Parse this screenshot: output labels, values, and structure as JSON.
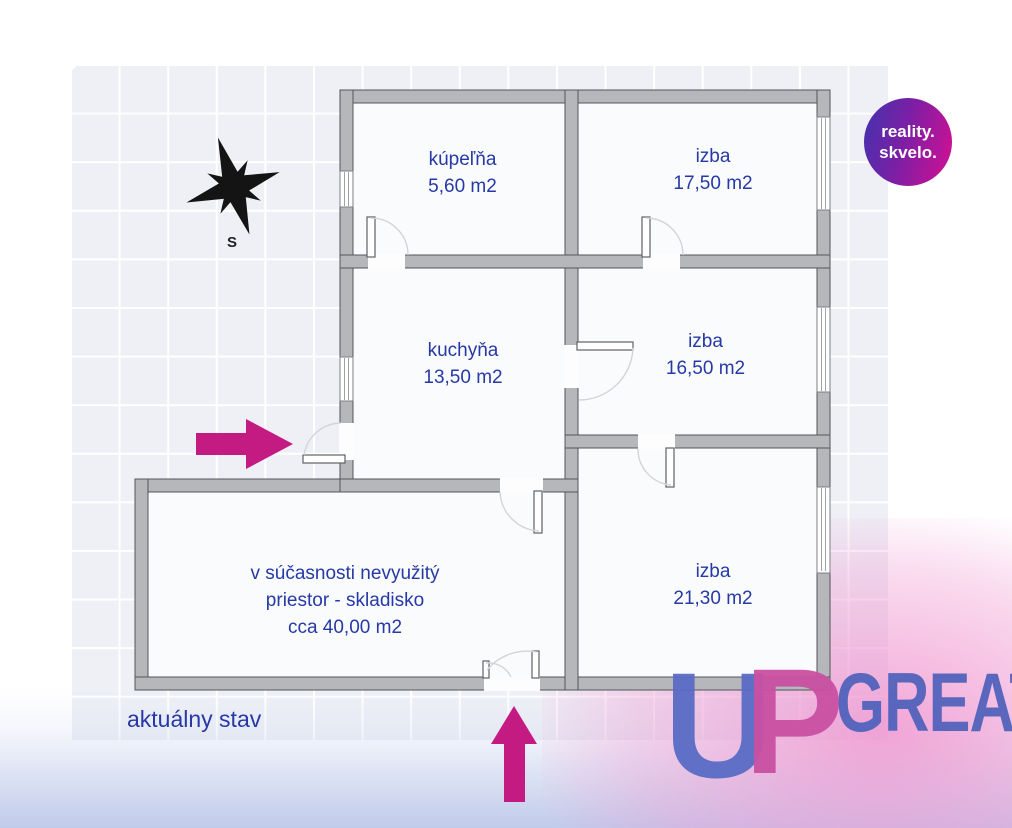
{
  "plan": {
    "caption": "aktuálny stav",
    "compass_label": "S",
    "rooms": [
      {
        "id": "kupelna",
        "name": "kúpeľňa",
        "area": "5,60 m2"
      },
      {
        "id": "izba-1",
        "name": "izba",
        "area": "17,50 m2"
      },
      {
        "id": "kuchyna",
        "name": "kuchyňa",
        "area": "13,50 m2"
      },
      {
        "id": "izba-2",
        "name": "izba",
        "area": "16,50 m2"
      },
      {
        "id": "izba-3",
        "name": "izba",
        "area": "21,30 m2"
      },
      {
        "id": "skladisko",
        "line1": "v súčasnosti nevyužitý",
        "line2": "priestor - skladisko",
        "line3": "cca 40,00 m2"
      }
    ]
  },
  "branding": {
    "badge": {
      "line1": "reality.",
      "line2": "skvelo."
    },
    "watermark": {
      "letter_u": "U",
      "letter_p": "P",
      "word": "GREAT"
    }
  },
  "colors": {
    "label_blue": "#2639a6",
    "arrow_magenta": "#c41b83",
    "wall_gray": "#b5b7bb",
    "room_fill": "#fafbfd",
    "grid_bg": "#eef0f6",
    "badge_gradient": [
      "#4133ae",
      "#d60f92"
    ],
    "watermark_blue": "#5a6cc6",
    "watermark_pink": "#ca50a2",
    "watermark_word_blue": "#5263bc"
  }
}
